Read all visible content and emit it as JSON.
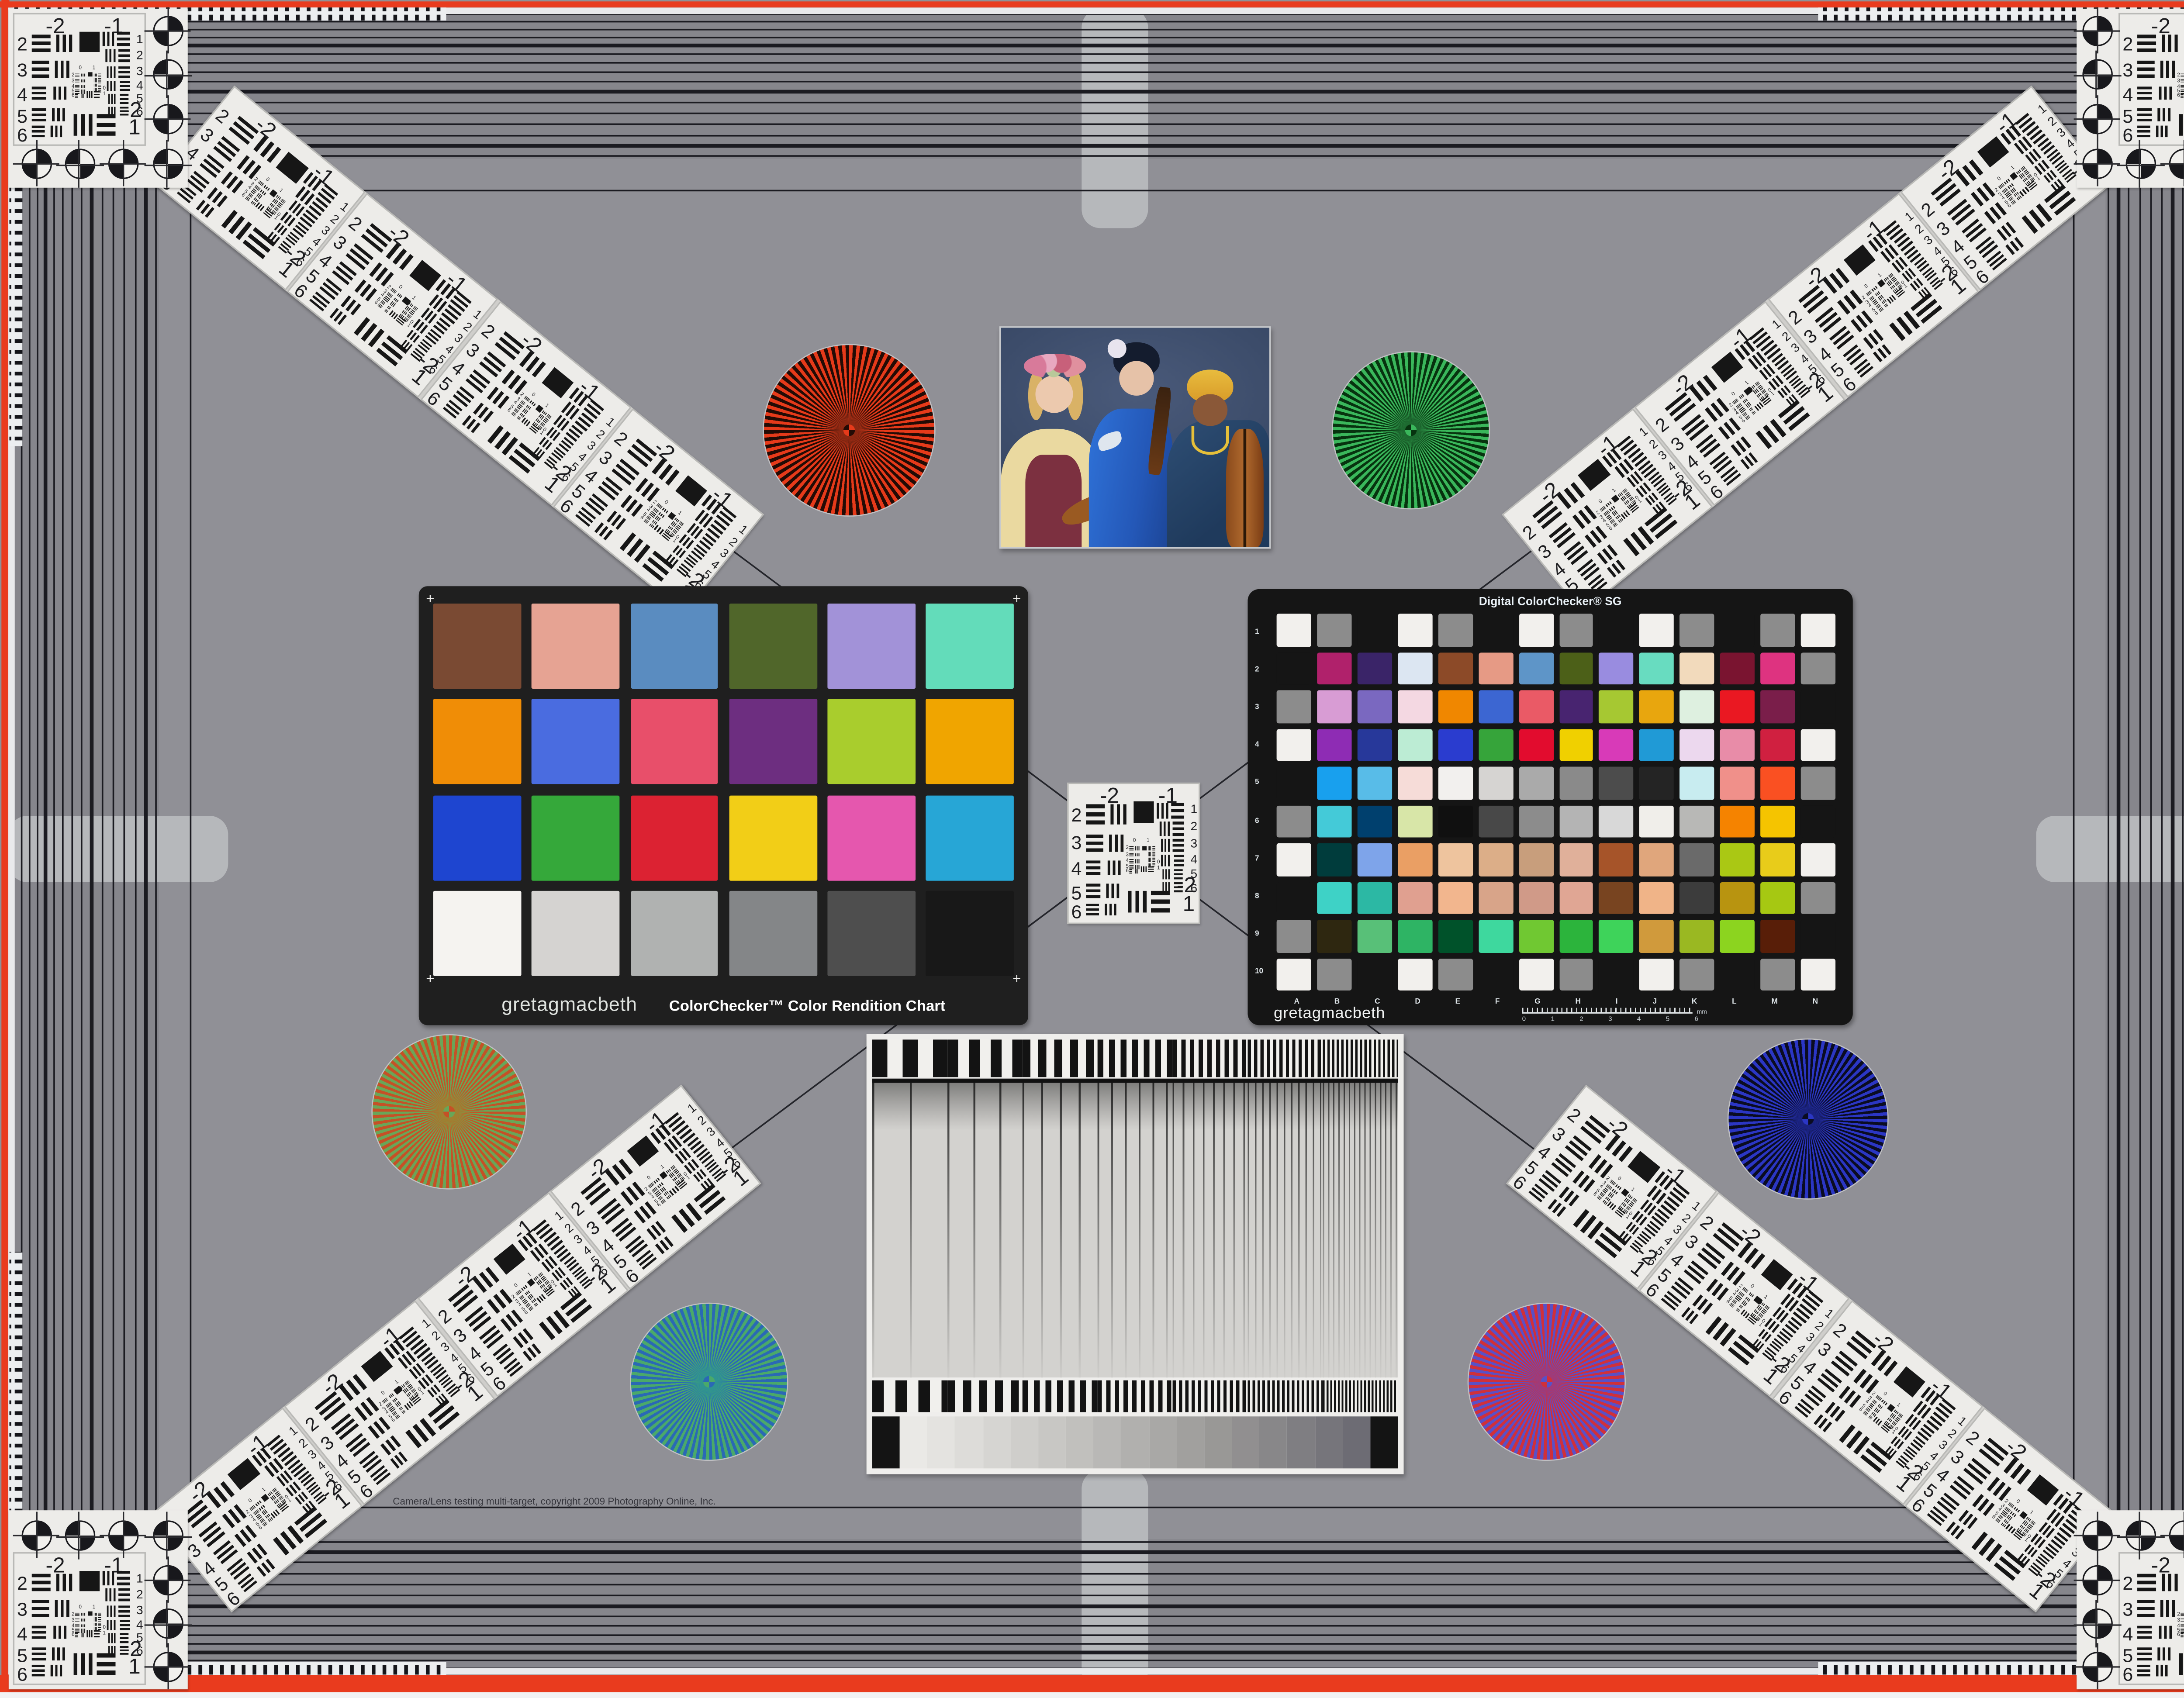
{
  "copyright": "Camera/Lens testing multi-target, copyright 2009 Photography Online, Inc.",
  "frame": {
    "red_border": "#e93b1e",
    "white_strip": "#eceef0",
    "band_background": "#86868c",
    "center_background": "#909096",
    "line_color": "#1b1b21",
    "tab_color": "#b6b8bb"
  },
  "usaf": {
    "top_labels": [
      "-2",
      "-1"
    ],
    "left_labels": [
      "2",
      "3",
      "4",
      "5",
      "6"
    ],
    "right_labels": [
      "1",
      "2",
      "3",
      "4",
      "5",
      "6"
    ],
    "corner_labels": [
      "-2",
      "1"
    ],
    "mini_labels": [
      "0",
      "1",
      "2",
      "3",
      "4",
      "5",
      "6",
      "0",
      "1"
    ]
  },
  "colorchecker": {
    "brand": "gretagmacbeth",
    "title": "ColorChecker™ Color Rendition Chart",
    "plus_mark": "+",
    "frame_color": "#1f1f1f",
    "patches": [
      "#7a4a33",
      "#e6a393",
      "#5a8cc0",
      "#50662a",
      "#a292d8",
      "#63dcba",
      "#f08d06",
      "#4a6ce0",
      "#e84f6a",
      "#6d2e80",
      "#a9cd2d",
      "#f0a500",
      "#1e45d0",
      "#35a83a",
      "#dc2232",
      "#f2ce17",
      "#e557ae",
      "#27a6d6",
      "#f5f3f0",
      "#d5d3d1",
      "#b0b2b1",
      "#848688",
      "#4e4e4e",
      "#181818"
    ]
  },
  "colorchecker_sg": {
    "brand": "gretagmacbeth",
    "title": "Digital ColorChecker® SG",
    "frame_color": "#141414",
    "row_labels": [
      "1",
      "2",
      "3",
      "4",
      "5",
      "6",
      "7",
      "8",
      "9",
      "10"
    ],
    "col_labels": [
      "A",
      "B",
      "C",
      "D",
      "E",
      "F",
      "G",
      "H",
      "I",
      "J",
      "K",
      "L",
      "M",
      "N"
    ],
    "ruler_labels": [
      "0",
      "1",
      "2",
      "3",
      "4",
      "5",
      "6"
    ],
    "ruler_unit": "mm",
    "patches": [
      [
        "#f2f0ed",
        "#8c8c8c",
        "#151515",
        "#f2f0ed",
        "#8c8c8c",
        "#151515",
        "#f2f0ed",
        "#8c8c8c",
        "#151515",
        "#f2f0ed",
        "#8c8c8c",
        "#151515",
        "#8c8c8c",
        "#f2f0ed"
      ],
      [
        "#151515",
        "#b0216b",
        "#3a2468",
        "#dce6f2",
        "#8c4a28",
        "#e69a85",
        "#5e95c8",
        "#4c6018",
        "#998ce0",
        "#68dcc0",
        "#f2dabc",
        "#7a1430",
        "#de3380",
        "#8c8c8c"
      ],
      [
        "#8c8c8c",
        "#d89cd4",
        "#7a68c0",
        "#f4d8e2",
        "#f08700",
        "#3c66d2",
        "#ea5a66",
        "#482470",
        "#a6c832",
        "#e8a60e",
        "#def0e0",
        "#ea1822",
        "#7a1e4a",
        "#151515"
      ],
      [
        "#f2f0ed",
        "#8e2cb4",
        "#27389a",
        "#bcecd4",
        "#2a3ccf",
        "#36a43a",
        "#e20c2e",
        "#f0d000",
        "#d83ab8",
        "#209ad6",
        "#ecd8ee",
        "#e88ca8",
        "#d02040",
        "#f2f0ed"
      ],
      [
        "#151515",
        "#18a0ee",
        "#58bce8",
        "#f6dcd8",
        "#f2f0ee",
        "#d6d4d2",
        "#aaaaaa",
        "#8a8a8a",
        "#4c4c4c",
        "#242424",
        "#c8ecf0",
        "#f0908a",
        "#fa5022",
        "#8c8c8c"
      ],
      [
        "#8c8c8c",
        "#44cad8",
        "#00406e",
        "#d8e6a8",
        "#101010",
        "#484848",
        "#8c8c8c",
        "#b4b4b4",
        "#d8d8d8",
        "#f0eeea",
        "#b8b8b6",
        "#f58300",
        "#f5c400",
        "#151515"
      ],
      [
        "#f2f0ed",
        "#003c3c",
        "#7ea4ea",
        "#ea9f64",
        "#eec49e",
        "#dcae88",
        "#c89e7c",
        "#e0b09a",
        "#a65429",
        "#e0a67c",
        "#6a6a6a",
        "#aac814",
        "#e8cc1a",
        "#f2f0ed"
      ],
      [
        "#151515",
        "#3ed2c6",
        "#2cb8a4",
        "#e0a090",
        "#f2b68e",
        "#d8a489",
        "#d09a88",
        "#e0a694",
        "#784420",
        "#f0b488",
        "#3c3c3c",
        "#b89410",
        "#a6c812",
        "#8c8c8c"
      ],
      [
        "#8c8c8c",
        "#2e2710",
        "#58c078",
        "#2eb464",
        "#00522a",
        "#3ed89e",
        "#70c832",
        "#2cb43c",
        "#3ed35a",
        "#d09a3c",
        "#9ab822",
        "#8cd41f",
        "#581e08",
        "#151515"
      ],
      [
        "#f2f0ed",
        "#8c8c8c",
        "#151515",
        "#f2f0ed",
        "#8c8c8c",
        "#151515",
        "#f2f0ed",
        "#8c8c8c",
        "#151515",
        "#f2f0ed",
        "#8c8c8c",
        "#151515",
        "#8c8c8c",
        "#f2f0ed"
      ]
    ]
  },
  "grayscale_chart": {
    "card_color": "#efeeec",
    "steps": [
      "#141414",
      "#eae9e6",
      "#e4e3e0",
      "#dddcd9",
      "#d6d5d2",
      "#cfcecb",
      "#c8c7c4",
      "#c1c0bd",
      "#b9b8b6",
      "#b1b0ae",
      "#a9a8a6",
      "#a1a09e",
      "#999896",
      "#918f90",
      "#888789",
      "#7f7e82",
      "#76757b",
      "#6d6c74",
      "#141414"
    ]
  },
  "starbursts": [
    {
      "name": "red",
      "ray1": "#e63a1a",
      "ray2": "#230b05",
      "mid": "#8c2812"
    },
    {
      "name": "green",
      "ray1": "#3ab75b",
      "ray2": "#07330f",
      "mid": "#1d6a30"
    },
    {
      "name": "gold",
      "ray1": "#c55126",
      "ray2": "#69a658",
      "mid": "#a08030"
    },
    {
      "name": "teal",
      "ray1": "#4aa96a",
      "ray2": "#2a69b5",
      "mid": "#2f9490"
    },
    {
      "name": "blue",
      "ray1": "#2b36c4",
      "ray2": "#0a0c22",
      "mid": "#1a2280"
    },
    {
      "name": "red-blue",
      "ray1": "#d0303a",
      "ray2": "#5a50c6",
      "mid": "#a03a78"
    }
  ]
}
